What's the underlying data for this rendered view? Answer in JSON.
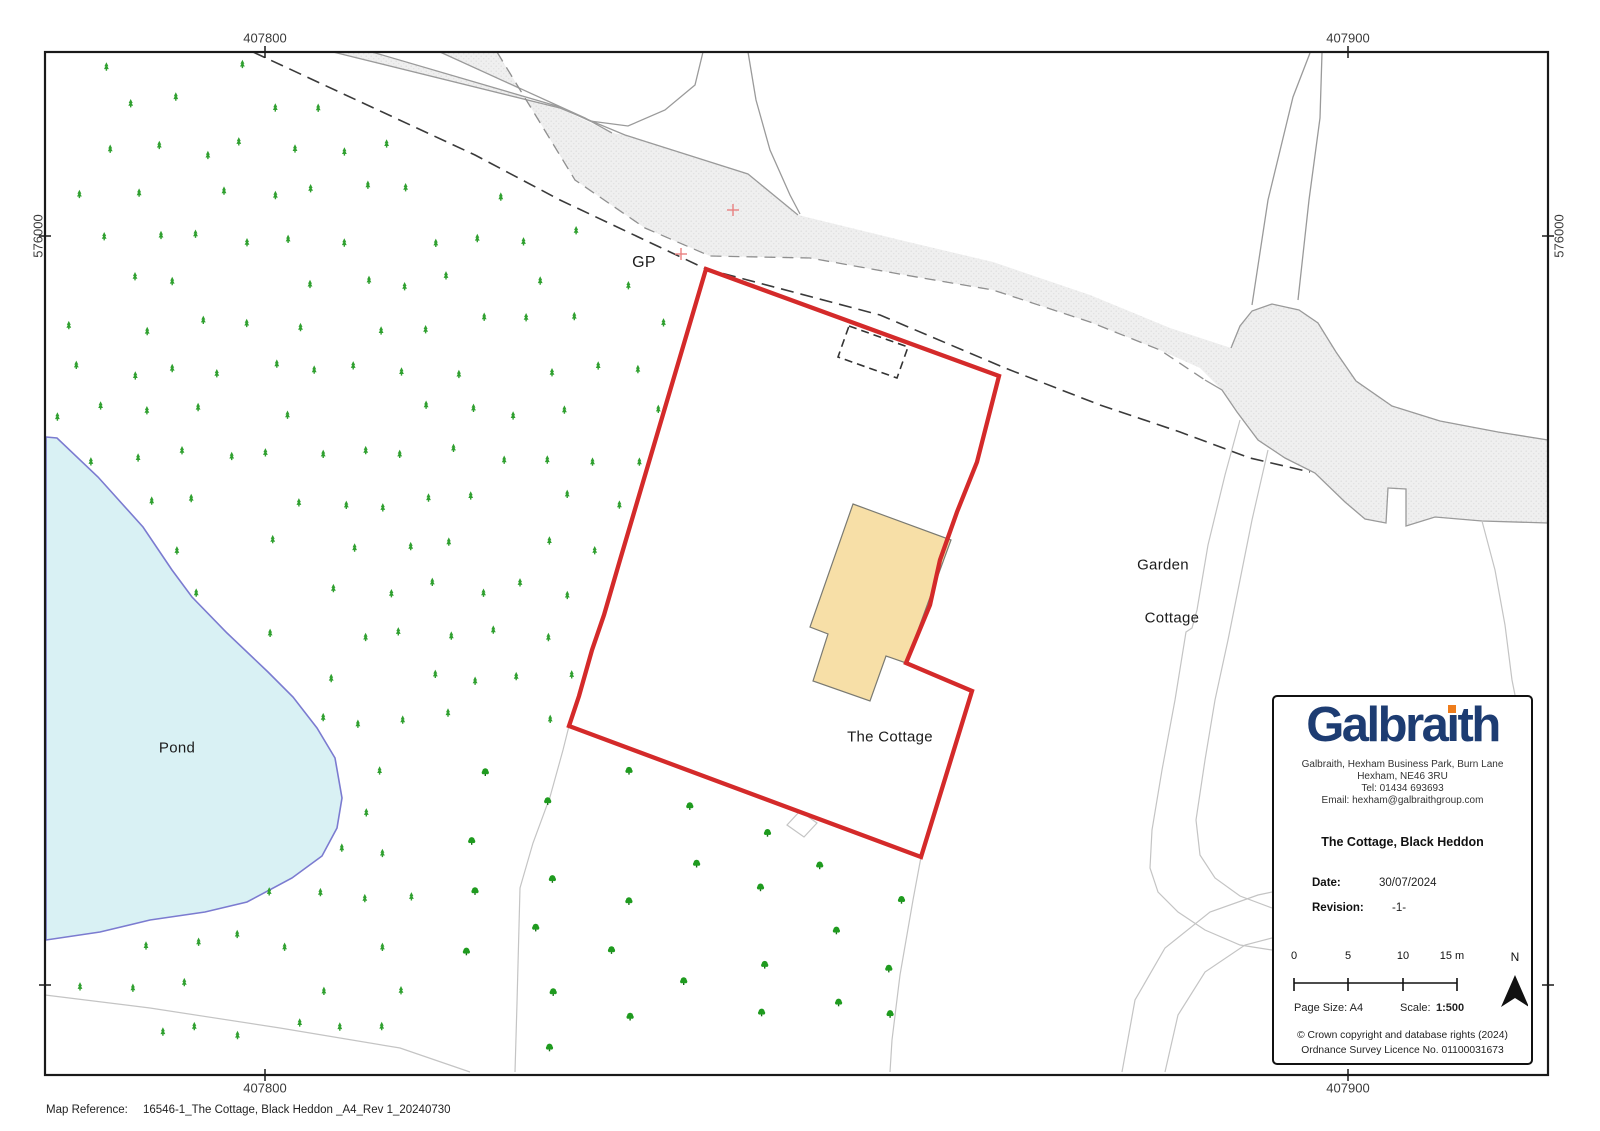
{
  "page": {
    "map_reference_label": "Map Reference:",
    "map_reference_value": "16546-1_The Cottage, Black Heddon _A4_Rev 1_20240730"
  },
  "grid": {
    "top_left": "407800",
    "top_right": "407900",
    "bottom_left": "407800",
    "bottom_right": "407900",
    "left": "576000",
    "right": "576000"
  },
  "map_labels": {
    "gp": "GP",
    "pond": "Pond",
    "the_cottage": "The Cottage",
    "garden": "Garden",
    "cottage": "Cottage"
  },
  "info_box": {
    "logo_pre": "Galbra",
    "logo_i": "ı",
    "logo_post": "th",
    "address_line1": "Galbraith, Hexham Business Park, Burn Lane",
    "address_line2": "Hexham, NE46 3RU",
    "address_line3": "Tel: 01434 693693",
    "address_line4": "Email: hexham@galbraithgroup.com",
    "title": "The Cottage, Black Heddon",
    "date_label": "Date:",
    "date_value": "30/07/2024",
    "revision_label": "Revision:",
    "revision_value": "-1-",
    "scale_tick0": "0",
    "scale_tick1": "5",
    "scale_tick2": "10",
    "scale_tick3": "15 m",
    "north_label": "N",
    "page_size": "Page Size: A4",
    "scale_label": "Scale:",
    "scale_value": "1:500",
    "copyright_line1": "© Crown copyright and database rights (2024)",
    "copyright_line2": "Ordnance Survey Licence No. 01100031673"
  },
  "colors": {
    "boundary_red": "#d42a2a",
    "building_fill": "#f7dfa7",
    "pond_fill": "#d9f1f4",
    "pond_edge": "#7b7bd0",
    "tree_green": "#2fa02f",
    "road_fill": "#efefef",
    "logo_navy": "#1d3c72",
    "logo_orange": "#ee7c1b"
  }
}
